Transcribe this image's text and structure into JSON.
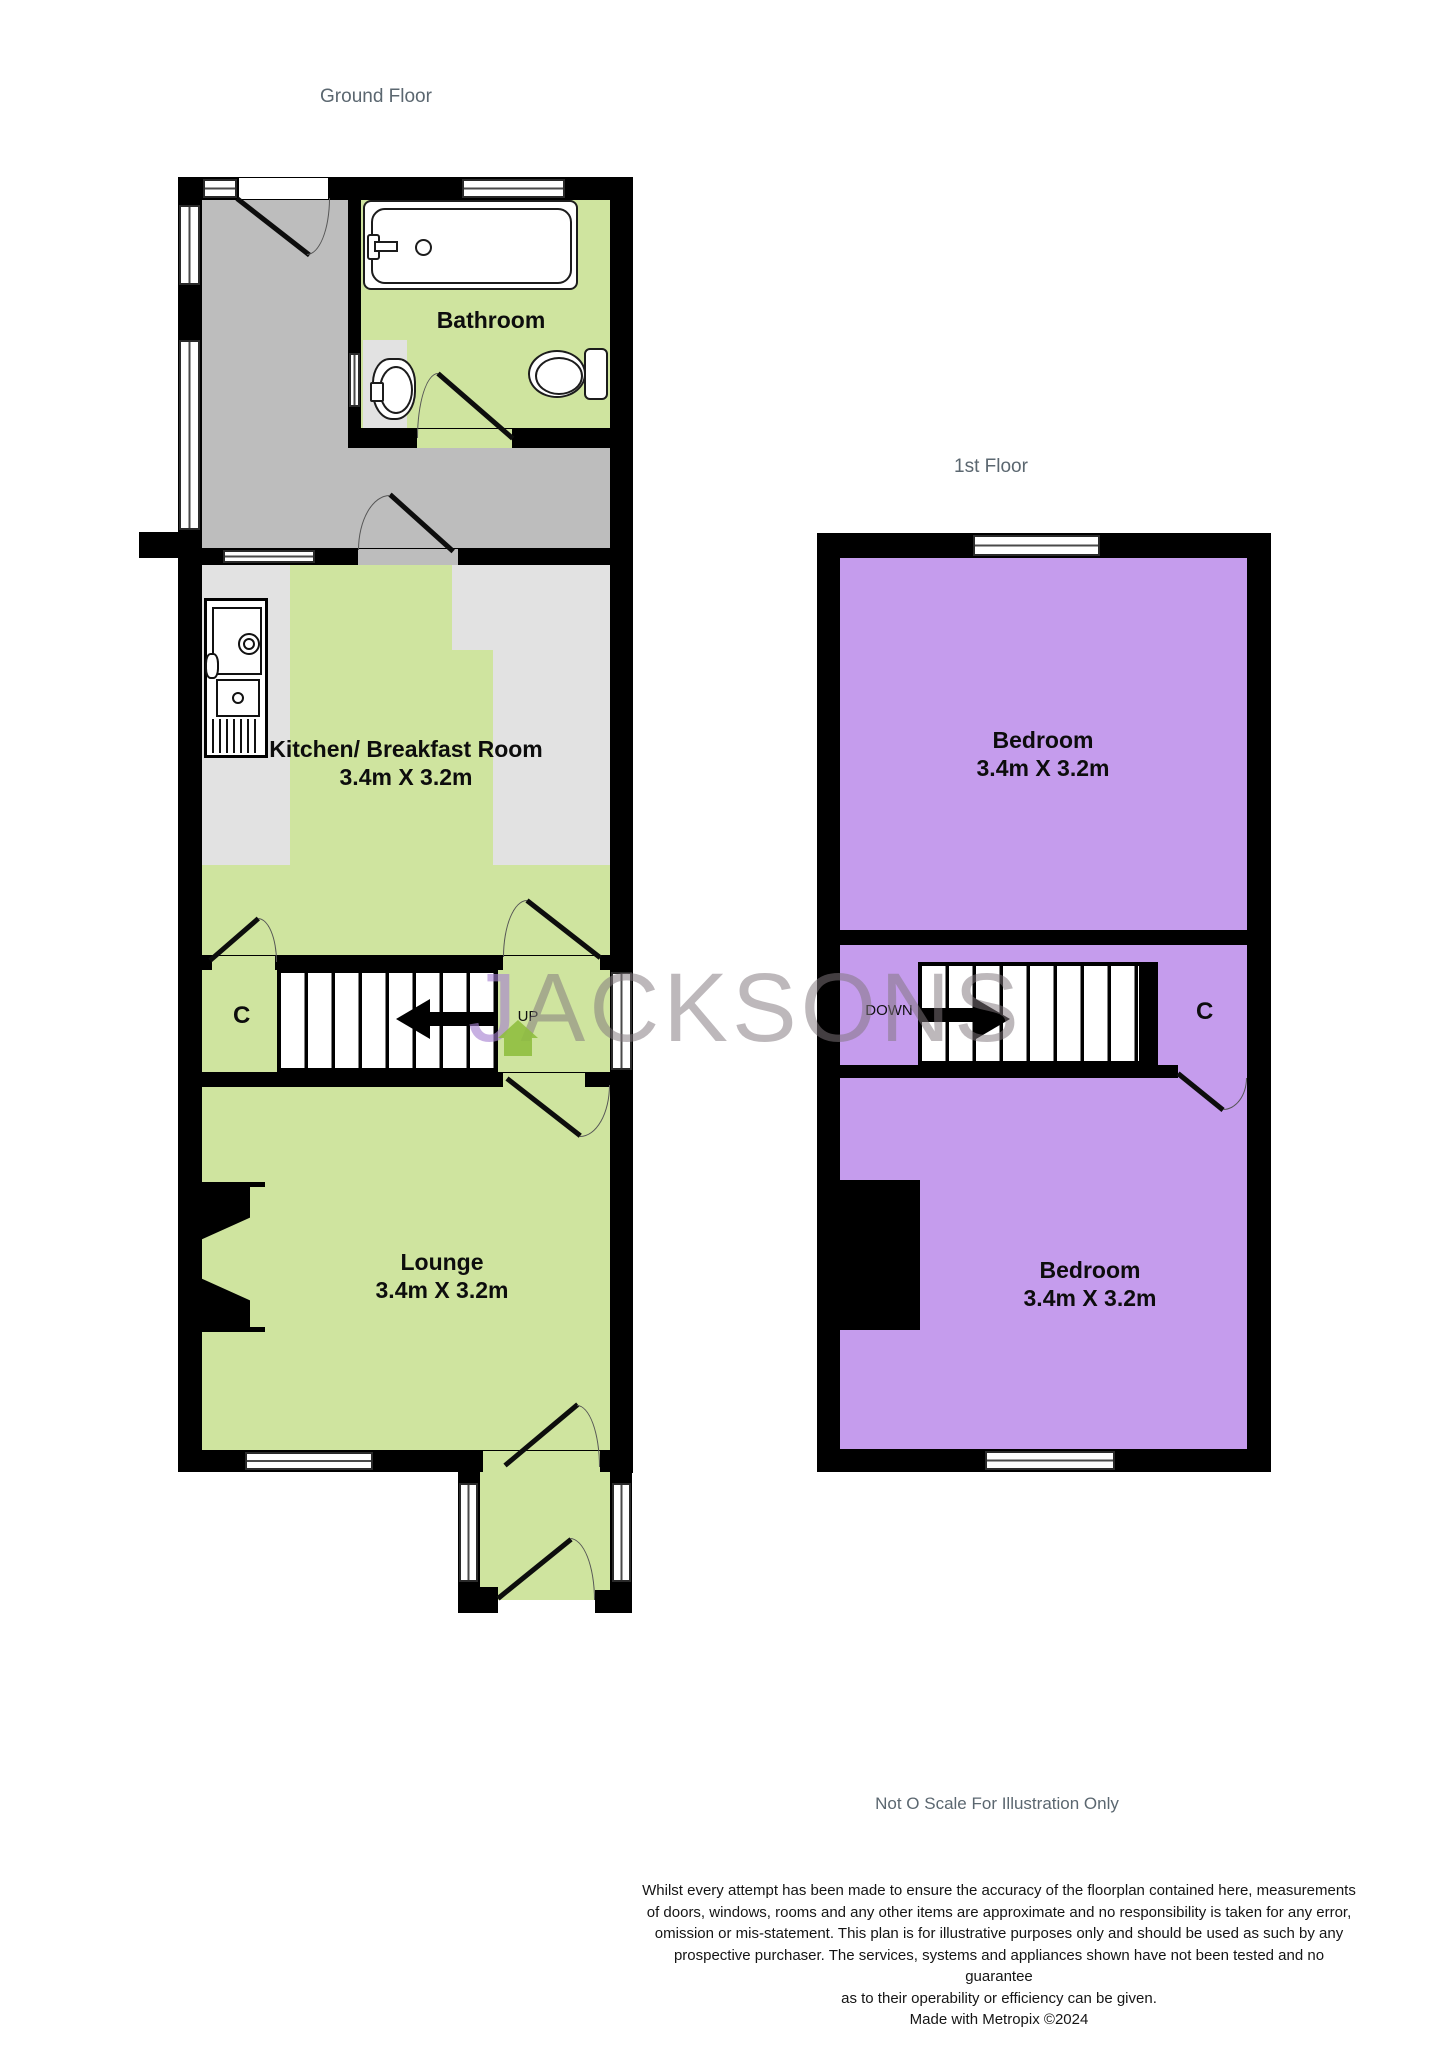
{
  "ground_floor": {
    "label": "Ground Floor",
    "rooms": {
      "bathroom": {
        "name": "Bathroom"
      },
      "kitchen": {
        "name": "Kitchen/ Breakfast Room",
        "dims": "3.4m X 3.2m"
      },
      "lounge": {
        "name": "Lounge",
        "dims": "3.4m X 3.2m"
      }
    },
    "closet_label": "C",
    "stairs_label": "UP"
  },
  "first_floor": {
    "label": "1st Floor",
    "rooms": {
      "bedroom_front": {
        "name": "Bedroom",
        "dims": "3.4m X 3.2m"
      },
      "bedroom_back": {
        "name": "Bedroom",
        "dims": "3.4m X 3.2m"
      }
    },
    "closet_label": "C",
    "stairs_label": "DOWN"
  },
  "watermark": {
    "first_letter": "J",
    "rest": "ACKSONS"
  },
  "footer": {
    "scale_note": "Not O Scale For Illustration Only",
    "disclaimer_lines": [
      "Whilst every attempt has been made to ensure the accuracy of the floorplan contained here, measurements",
      "of doors, windows, rooms and any other items are approximate and no responsibility is taken for any error,",
      "omission or mis-statement. This plan is for illustrative purposes only and should be used as such by any",
      "prospective purchaser. The services, systems and appliances shown have not been tested and no guarantee",
      "as to their operability or efficiency can be given."
    ],
    "credit": "Made with Metropix ©2024"
  },
  "colors": {
    "wall": "#000000",
    "green": "#cfe49f",
    "purple": "#c59ced",
    "hall": "#bdbdbd",
    "counter": "#e2e2e2",
    "label": "#5b6770",
    "text": "#0d0d0d",
    "watermark_gray": "rgba(128,118,124,0.52)",
    "watermark_purple": "rgba(164,128,209,0.62)",
    "house": "#8fbe3f"
  }
}
